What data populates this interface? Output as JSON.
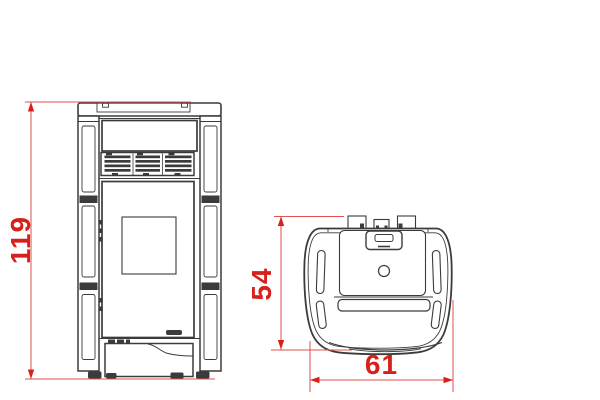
{
  "colors": {
    "dimension_red": "#d8201b",
    "dimension_line": "#e2524e",
    "line_dark": "#3b3b3b",
    "background": "#ffffff"
  },
  "dimensions": {
    "height": {
      "value": "119"
    },
    "depth": {
      "value": "54"
    },
    "width": {
      "value": "61"
    }
  }
}
